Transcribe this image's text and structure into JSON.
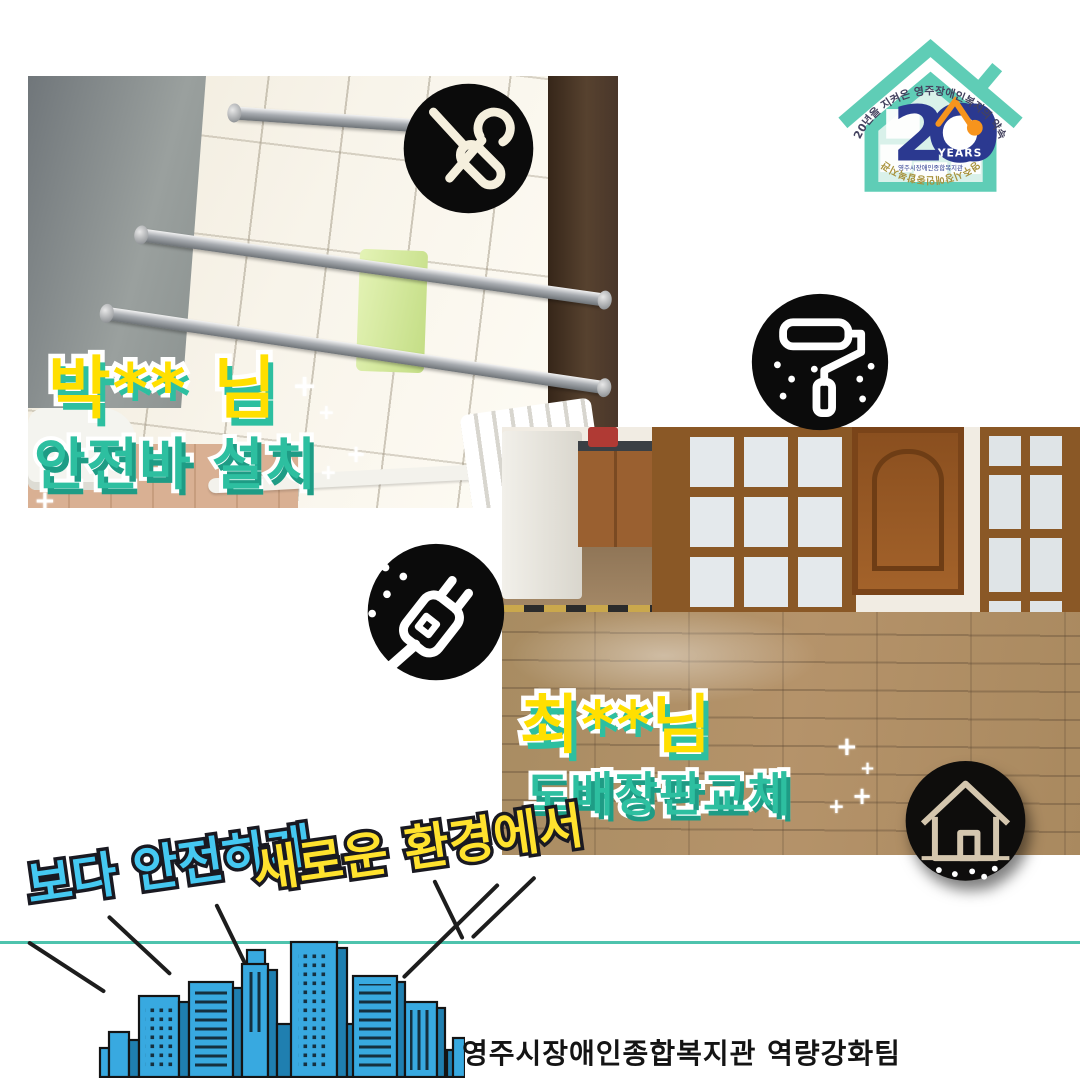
{
  "colors": {
    "teal_accent": "#2dbfa0",
    "label_yellow": "#ffdf00",
    "slogan_cyan": "#45c8f1",
    "slogan_yellow": "#ffe22e",
    "divider_teal": "#4ec3ad",
    "building_blue": "#38a9e0",
    "logo_teal": "#5fcdb6",
    "logo_navy": "#2b3990",
    "logo_orange": "#f7941d"
  },
  "logo": {
    "arc_top": "20년을 지켜온 영주장애인복지의 약속",
    "number": "20",
    "years_label": "YEARS",
    "org_small": "영주시장애인종합복지관",
    "arc_bottom": "영주시장애인종합복지관"
  },
  "cards": [
    {
      "client": "박** 님",
      "service": "안전바 설치"
    },
    {
      "client": "최**님",
      "service": "도배장판교체"
    }
  ],
  "slogans": {
    "left": "보다 안전하게",
    "right": "새로운 환경에서"
  },
  "footer": {
    "team": "영주시장애인종합복지관 역량강화팀"
  },
  "icons": [
    "tools-icon",
    "paint-roller-icon",
    "plug-icon",
    "house-icon"
  ],
  "sparkle": "+"
}
